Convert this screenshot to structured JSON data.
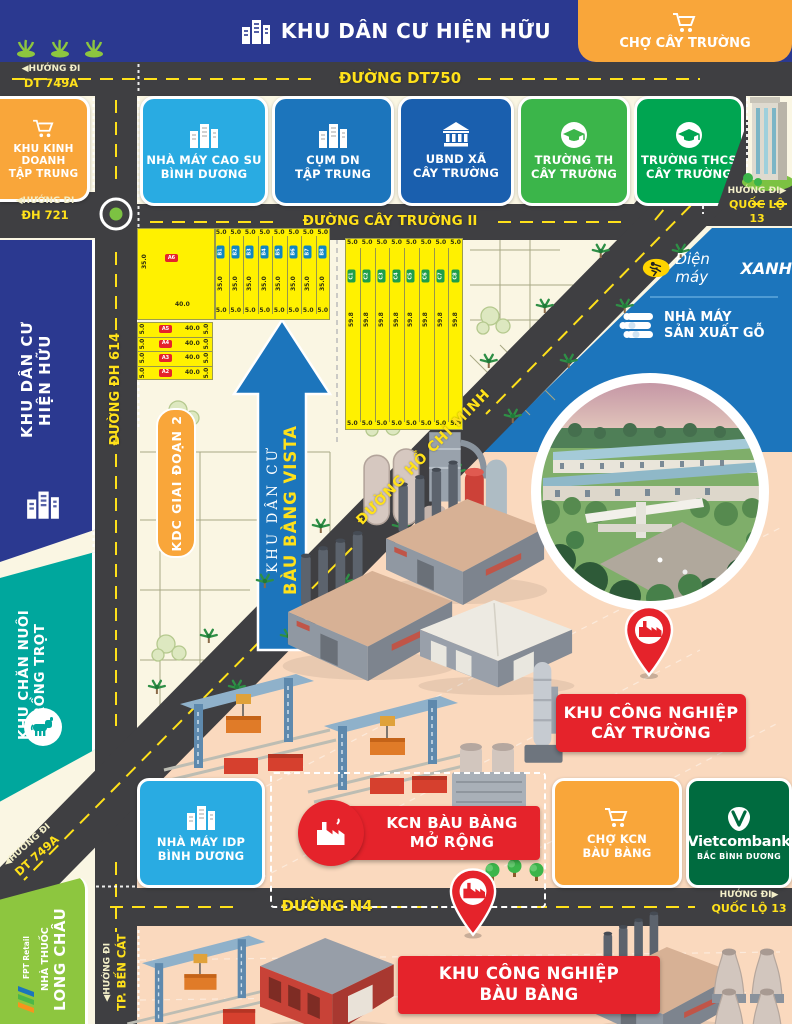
{
  "banner": {
    "title": "KHU DÂN CƯ HIỆN HỮU",
    "market": "CHỢ CÂY TRƯỜNG"
  },
  "roads": {
    "dt750": "ĐƯỜNG DT750",
    "cay_truong_2": "ĐƯỜNG CÂY TRƯỜNG II",
    "dh614": "ĐƯỜNG ĐH 614",
    "ho_chi_minh": "ĐƯỜNG HỒ CHÍ MINH",
    "n4": "ĐƯỜNG N4"
  },
  "directions": {
    "dt749a_top": {
      "l1": "◀HƯỚNG ĐI",
      "l2": "DT 749A"
    },
    "dh721": {
      "l1": "◀HƯỚNG ĐI",
      "l2": "ĐH 721"
    },
    "ql13_top": {
      "l1": "HƯỚNG ĐI▶",
      "l2": "QUỐC LỘ 13"
    },
    "dt749a_bottom": {
      "l1": "◀HƯỚNG ĐI",
      "l2": "DT 749A"
    },
    "ben_cat": {
      "l1": "◀HƯỚNG ĐI",
      "l2": "TP. BẾN CÁT"
    },
    "ql13_bottom": {
      "l1": "HƯỚNG ĐI▶",
      "l2": "QUỐC LỘ 13"
    }
  },
  "left_panels": {
    "business": {
      "l1": "KHU KINH DOANH",
      "l2": "TẬP TRUNG"
    },
    "residential": {
      "l1": "KHU DÂN CƯ",
      "l2": "HIỆN HỮU"
    },
    "farming": {
      "l1": "KHU CHĂN NUÔI",
      "l2": "TRỒNG TRỌT"
    },
    "pharmacy": {
      "prefix": "NHÀ THUỐC",
      "name": "LONG CHÂU",
      "brand": "FPT Retail"
    }
  },
  "facilities": [
    {
      "l1": "NHÀ MÁY CAO SU",
      "l2": "BÌNH DƯƠNG",
      "color": "#29ABE2",
      "icon": "buildings"
    },
    {
      "l1": "CỤM DN",
      "l2": "TẬP TRUNG",
      "color": "#1C75BC",
      "icon": "buildings"
    },
    {
      "l1": "UBND XÃ",
      "l2": "CÂY TRƯỜNG",
      "color": "#1A5FAE",
      "icon": "government"
    },
    {
      "l1": "TRƯỜNG TH",
      "l2": "CÂY TRƯỜNG",
      "color": "#3BB54A",
      "icon": "graduation"
    },
    {
      "l1": "TRƯỜNG THCS",
      "l2": "CÂY TRƯỜNG",
      "color": "#00A551",
      "icon": "graduation"
    }
  ],
  "right_panel": {
    "brand_italic": "Điện máy",
    "brand_bold": "XANH",
    "wood": {
      "l1": "NHÀ MÁY",
      "l2": "SẢN XUẤT GỖ"
    }
  },
  "project": {
    "phase2": "KDC GIAI ĐOẠN 2",
    "arrow_top": "KHU DÂN CƯ",
    "arrow_name": "BÀU BÀNG VISTA"
  },
  "lot_plan": {
    "cell_width": "5.0",
    "block_b": {
      "count": 8,
      "depth": "35.0",
      "labels": [
        "B1",
        "B2",
        "B3",
        "B4",
        "B5",
        "B6",
        "B7",
        "B8"
      ]
    },
    "big_lot": {
      "label": "A6",
      "depth": "35.0",
      "width": "40.0"
    },
    "rows_a": {
      "height": "5.0",
      "width": "40.0",
      "labels": [
        "A5",
        "A4",
        "A3",
        "A2"
      ]
    },
    "block_c": {
      "count": 8,
      "depth": "59.8",
      "labels": [
        "C1",
        "C2",
        "C3",
        "C4",
        "C5",
        "C6",
        "C7",
        "C8"
      ]
    }
  },
  "industrial": {
    "cay_truong": {
      "l1": "KHU CÔNG NGHIỆP",
      "l2": "CÂY TRƯỜNG"
    },
    "expand": {
      "l1": "KCN BÀU BÀNG",
      "l2": "MỞ RỘNG"
    },
    "bau_bang": {
      "l1": "KHU CÔNG NGHIỆP",
      "l2": "BÀU BÀNG"
    }
  },
  "bottom_row": {
    "idp": {
      "l1": "NHÀ MÁY IDP",
      "l2": "BÌNH DƯƠNG"
    },
    "market": {
      "l1": "CHỢ KCN",
      "l2": "BÀU BÀNG"
    },
    "bank": {
      "name": "Vietcombank",
      "sub": "BẮC BÌNH DƯƠNG"
    }
  },
  "colors": {
    "navy": "#2B3990",
    "orange": "#F9A63A",
    "red": "#E5232B",
    "road": "#3F3F42",
    "yellow": "#FFE11A",
    "lot_yellow": "#FFF100",
    "teal": "#00A79D",
    "green": "#8DC63F",
    "vcb_green": "#006B3F",
    "light_blue": "#29ABE2",
    "panel_blue": "#1C75BC"
  }
}
